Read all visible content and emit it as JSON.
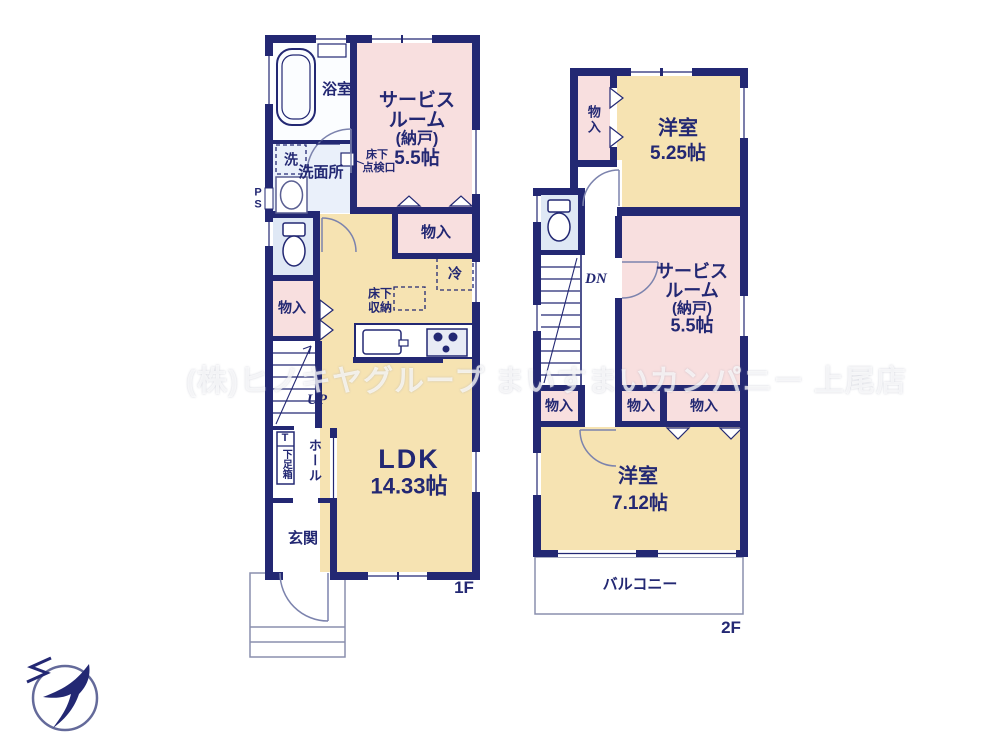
{
  "watermark": "(株)ヒノキヤグループ まいすまいカンパニー 上尾店",
  "colors": {
    "wall": "#232873",
    "room_yellow": "#f6e3b2",
    "room_pink": "#f8dfdf",
    "room_blue": "#dfe8f5"
  },
  "compass": {
    "north": "N"
  },
  "floor1": {
    "floor_label": "1F",
    "bath": "浴室",
    "washer": "洗",
    "washroom": "洗面所",
    "service_room": [
      "サービス",
      "ルーム",
      "(納戸)",
      "5.5帖"
    ],
    "inspection_hatch": [
      "床下",
      "点検口"
    ],
    "pipe_space": "P\nS",
    "storage_left": "物入",
    "storage_top": "物入",
    "fridge": "冷",
    "underfloor_storage": [
      "床下",
      "収納"
    ],
    "ldk": [
      "LDK",
      "14.33帖"
    ],
    "stairs_up": "UP",
    "shoe_box_t": "T",
    "shoe_box": "下足箱",
    "hall": "ホール",
    "entrance": "玄関"
  },
  "floor2": {
    "floor_label": "2F",
    "storage_upper": "物入",
    "bedroom1": [
      "洋室",
      "5.25帖"
    ],
    "stairs_down": "DN",
    "service_room": [
      "サービス",
      "ルーム",
      "(納戸)",
      "5.5帖"
    ],
    "storage_row": [
      "物入",
      "物入",
      "物入"
    ],
    "bedroom2": [
      "洋室",
      "7.12帖"
    ],
    "balcony": "バルコニー"
  }
}
